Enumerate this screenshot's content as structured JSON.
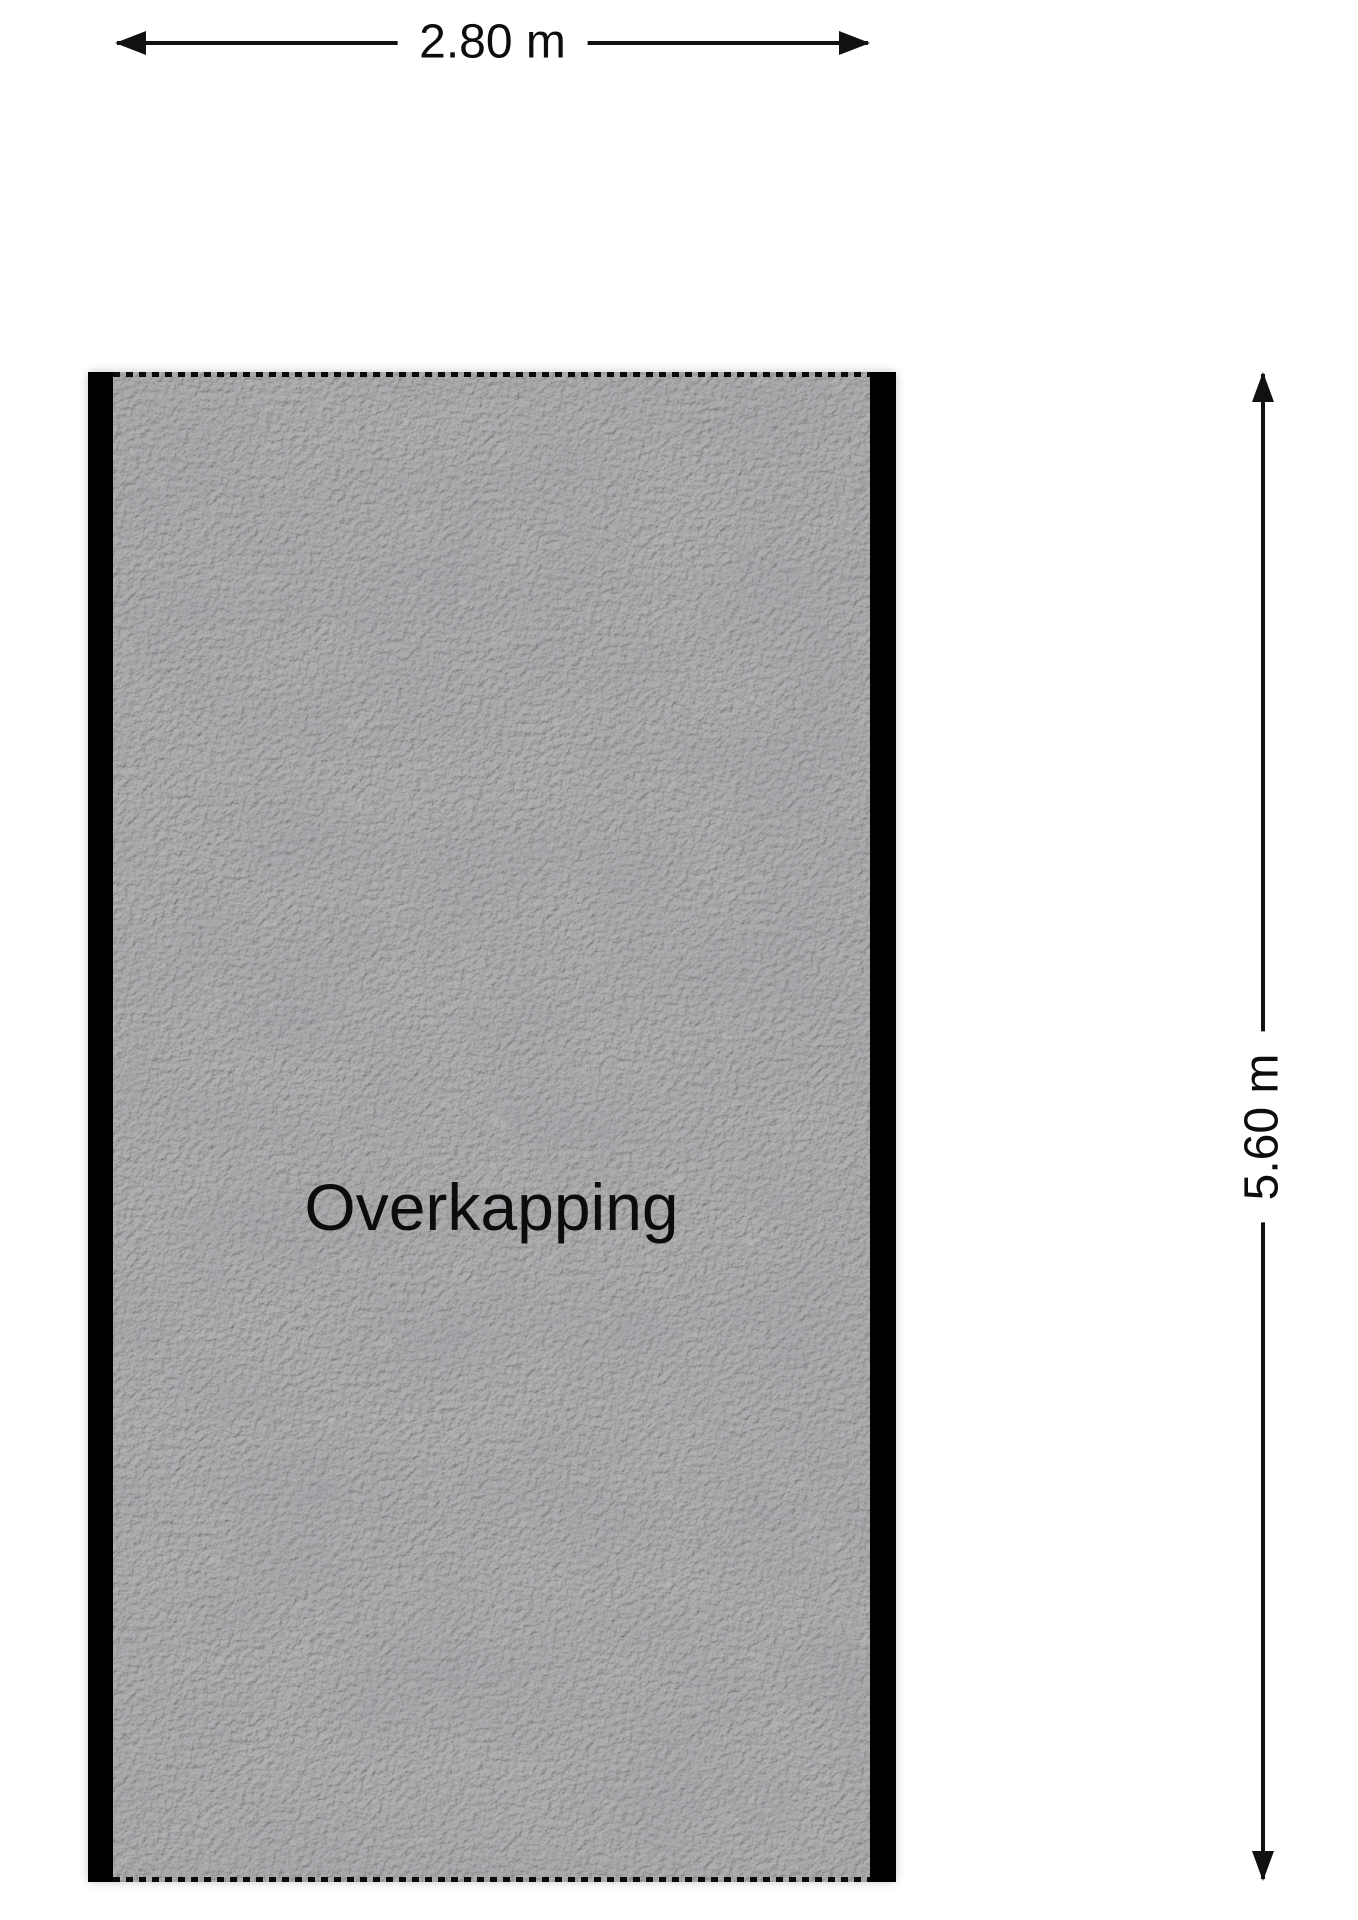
{
  "floor_plan": {
    "room_label": "Overkapping",
    "width_dimension_label": "2.80 m",
    "height_dimension_label": "5.60 m"
  },
  "colors": {
    "wall": "#000000",
    "floor_base": "#9d9e9f",
    "dimension_line": "#111111",
    "text": "#0d0d0d",
    "background": "#ffffff"
  },
  "icons": {
    "arrow_left": "css-triangle-left",
    "arrow_right": "css-triangle-right",
    "arrow_up": "css-triangle-up",
    "arrow_down": "css-triangle-down"
  }
}
